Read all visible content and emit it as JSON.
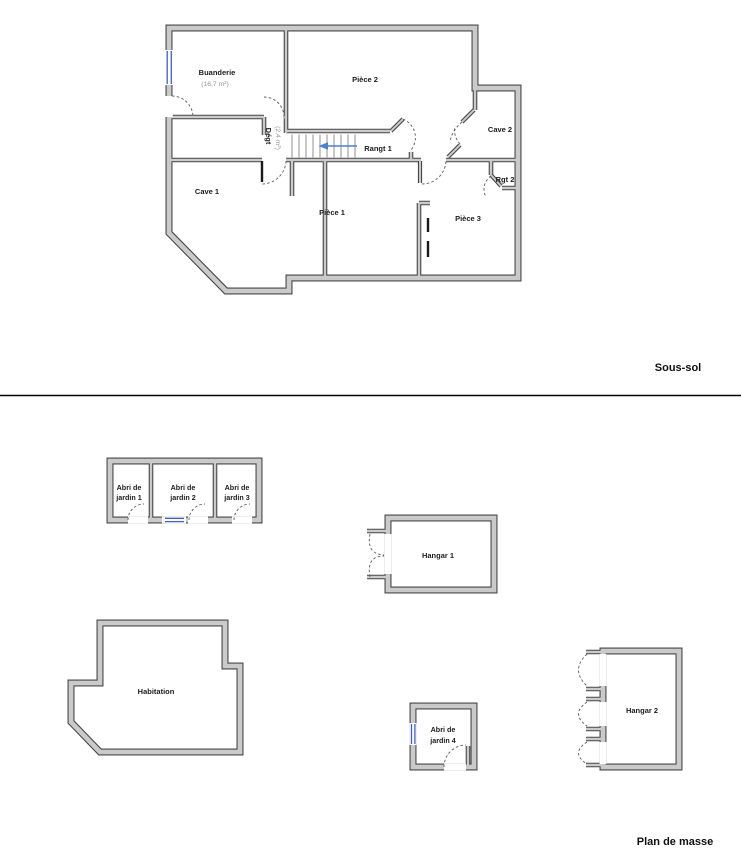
{
  "page": {
    "background": "#ffffff"
  },
  "colors": {
    "wall_fill": "#cacaca",
    "wall_edge": "#474747",
    "window_blue": "#3d5fd0",
    "stair_arrow_blue": "#4a7fd4",
    "door_arc_gray": "#5a5a5a",
    "divider_black": "#000000"
  },
  "sections": {
    "sous_sol": {
      "title": "Sous-sol",
      "stair_arrow_direction": "left",
      "rooms": {
        "buanderie": {
          "name": "Buanderie",
          "area": "(16,7 m²)"
        },
        "piece2": {
          "name": "Pièce 2"
        },
        "cave2": {
          "name": "Cave 2"
        },
        "rangt1": {
          "name": "Rangt 1"
        },
        "rgt2": {
          "name": "Rgt 2"
        },
        "cave1": {
          "name": "Cave 1"
        },
        "piece1": {
          "name": "Pièce 1"
        },
        "piece3": {
          "name": "Pièce 3"
        },
        "degagement": {
          "name": "Dégt",
          "area": "(2,4 m²)"
        }
      }
    },
    "plan_de_masse": {
      "title": "Plan de masse",
      "buildings": {
        "abri1": {
          "line1": "Abri de",
          "line2": "jardin 1"
        },
        "abri2": {
          "line1": "Abri de",
          "line2": "jardin 2"
        },
        "abri3": {
          "line1": "Abri de",
          "line2": "jardin 3"
        },
        "hangar1": {
          "name": "Hangar 1"
        },
        "habitation": {
          "name": "Habitation"
        },
        "abri4": {
          "line1": "Abri de",
          "line2": "jardin 4"
        },
        "hangar2": {
          "name": "Hangar 2"
        }
      }
    }
  }
}
